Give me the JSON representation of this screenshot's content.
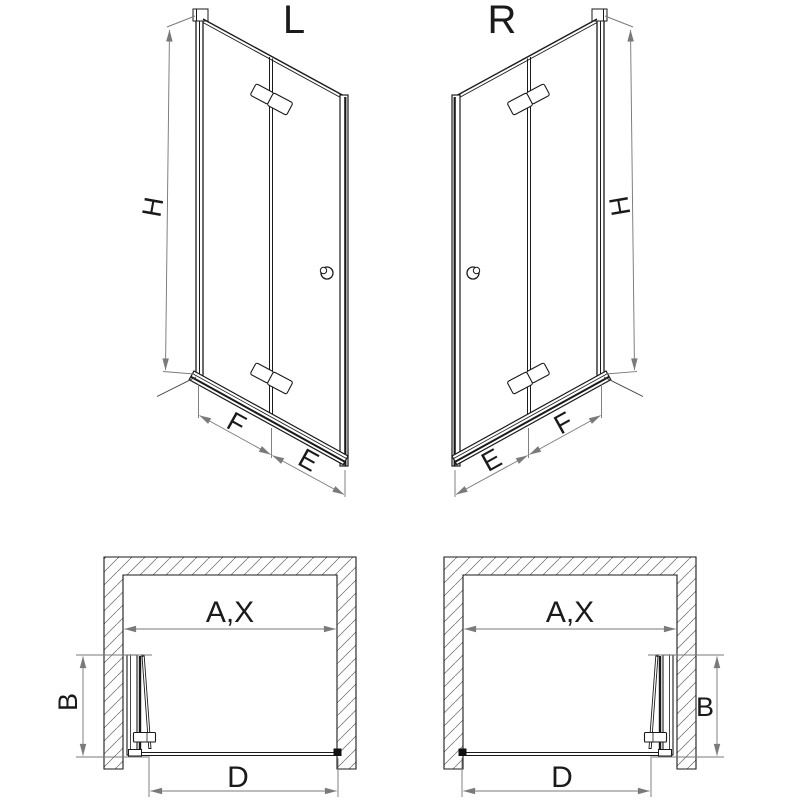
{
  "document_type": "technical-installation-diagram",
  "colors": {
    "line": "#1a1a1a",
    "dimension": "#7a7a7a",
    "hatch": "#6a6a6a",
    "background": "#ffffff"
  },
  "views": {
    "iso_left": {
      "label": "L",
      "height_dim": "H",
      "near_panel_dim": "F",
      "far_panel_dim": "E"
    },
    "iso_right": {
      "label": "R",
      "height_dim": "H",
      "near_panel_dim": "F",
      "far_panel_dim": "E"
    },
    "plan_left": {
      "width_dim": "A,X",
      "fold_depth_dim": "B",
      "entry_dim": "D"
    },
    "plan_right": {
      "width_dim": "A,X",
      "fold_depth_dim": "B",
      "entry_dim": "D"
    }
  }
}
